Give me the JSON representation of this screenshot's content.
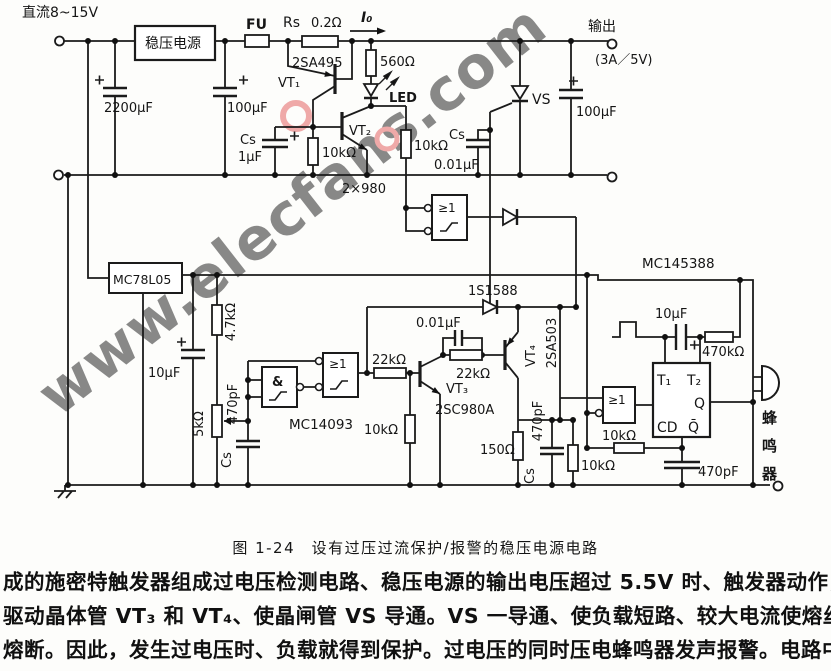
{
  "watermark": {
    "text": "www.elecfans.com",
    "color": "#e25858"
  },
  "caption": "图 1-24　设有过压过流保护/报警的稳压电源电路",
  "paragraph": {
    "l1": "成的施密特触发器组成过电压检测电路、稳压电源的输出电压超过 5.5V 时、触发器动作，",
    "l2": "驱动晶体管 VT₃ 和 VT₄、使晶闸管 VS 导通。VS 一导通、使负载短路、较大电流使熔丝 FU",
    "l3": "熔断。因此，发生过电压时、负载就得到保护。过电压的同时压电蜂鸣器发声报警。电路中，"
  },
  "labels": {
    "dc_input": "直流8~15V",
    "regulator": "稳压电源",
    "fuse": "FU",
    "rs": "Rs",
    "rs_value": "0.2Ω",
    "i0": "I₀",
    "output": "输出",
    "output_rating": "(3A／5V)",
    "c2200": "2200μF",
    "c100_in": "100μF",
    "cs1": "Cs",
    "cs1_value": "1μF",
    "vt1_part": "2SA495",
    "vt1": "VT₁",
    "r560": "560Ω",
    "led": "LED",
    "vt2": "VT₂",
    "r10k_a": "10kΩ",
    "r10k_b": "10kΩ",
    "cs2": "Cs",
    "cs2_value": "0.01μF",
    "vs": "VS",
    "c100_out": "100μF",
    "pair980": "2×980",
    "gate1": "≥1",
    "mc78l05": "MC78L05",
    "r4k7": "4.7kΩ",
    "c10u_a": "10μF",
    "r5k": "5kΩ",
    "c470p_a": "470pF",
    "cs3": "Cs",
    "gate2": "&",
    "mc14093": "MC14093",
    "gate3": "≥1",
    "r22k_a": "22kΩ",
    "c001_b": "0.01μF",
    "d1": "1S1588",
    "r22k_b": "22kΩ",
    "vt3": "VT₃",
    "vt3_part": "2SC980A",
    "r10k_c": "10kΩ",
    "r150": "150Ω",
    "c470p_b": "470pF",
    "cs4": "Cs",
    "vt4": "VT₄",
    "vt4_part": "2SA503",
    "mc145388": "MC145388",
    "c10u_b": "10μF",
    "r470k": "470kΩ",
    "t1": "T₁",
    "t2": "T₂",
    "q": "Q",
    "cd": "CD",
    "qbar": "Q̄",
    "gate4": "≥1",
    "r10k_d": "10kΩ",
    "r10k_e": "10kΩ",
    "c470p_c": "470pF",
    "buzzer": "蜂鸣器"
  }
}
